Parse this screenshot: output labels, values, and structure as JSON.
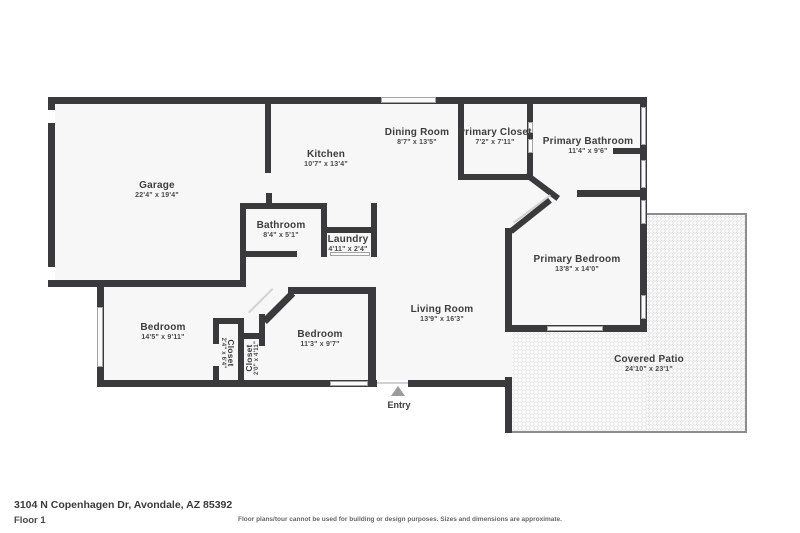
{
  "meta": {
    "address": "3104 N Copenhagen Dr, Avondale, AZ 85392",
    "floor_label": "Floor 1",
    "disclaimer": "Floor plans/tour cannot be used for building or design purposes. Sizes and dimensions are approximate."
  },
  "entry": {
    "label": "Entry"
  },
  "colors": {
    "wall": "#3a3a3c",
    "room_fill": "#f7f7f7",
    "patio_border": "#8d8d8d",
    "entry_arrow": "#9b9b9b"
  },
  "rooms": [
    {
      "id": "garage",
      "name": "Garage",
      "dims": "22'4\" x 19'4\""
    },
    {
      "id": "kitchen",
      "name": "Kitchen",
      "dims": "10'7\" x 13'4\""
    },
    {
      "id": "dining-room",
      "name": "Dining Room",
      "dims": "8'7\" x 13'5\""
    },
    {
      "id": "primary-closet",
      "name": "Primary Closet",
      "dims": "7'2\" x 7'11\""
    },
    {
      "id": "primary-bathroom",
      "name": "Primary Bathroom",
      "dims": "11'4\" x 9'6\""
    },
    {
      "id": "bathroom",
      "name": "Bathroom",
      "dims": "8'4\" x 5'1\""
    },
    {
      "id": "laundry",
      "name": "Laundry",
      "dims": "4'11\" x 2'4\""
    },
    {
      "id": "living-room",
      "name": "Living Room",
      "dims": "13'9\" x 16'3\""
    },
    {
      "id": "primary-bedroom",
      "name": "Primary Bedroom",
      "dims": "13'8\" x 14'0\""
    },
    {
      "id": "bedroom-left",
      "name": "Bedroom",
      "dims": "14'5\" x 9'11\""
    },
    {
      "id": "closet-left",
      "name": "Closet",
      "dims": "2'4\" x 6'4\""
    },
    {
      "id": "closet-right",
      "name": "Closet",
      "dims": "2'0\" x 4'11\""
    },
    {
      "id": "bedroom-right",
      "name": "Bedroom",
      "dims": "11'3\" x 9'7\""
    },
    {
      "id": "covered-patio",
      "name": "Covered Patio",
      "dims": "24'10\" x 23'1\""
    }
  ]
}
